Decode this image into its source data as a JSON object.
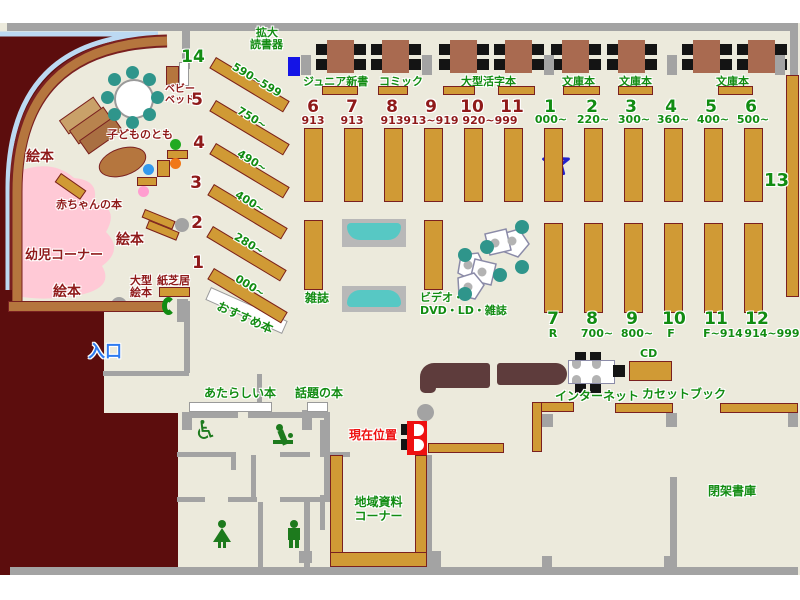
{
  "colors": {
    "floor": "#eceadc",
    "wall_gray": "#a3a3a3",
    "outside_maroon": "#5c0d0d",
    "shelf_gold": "#d09a35",
    "curve_wall_brown": "#b5763e",
    "outer_line_blue": "#bcd9f2",
    "toddler_area_pink": "#ffc9d6",
    "table_brown": "#a96a50",
    "counter_brown": "#5e3c3c",
    "seat_teal": "#2f958b",
    "sofa_teal": "#57c8c4",
    "green_text": "#128c12",
    "dark_red_text": "#8f1a1a",
    "entrance_blue": "#2e7bf0",
    "marker_red": "#ee1111",
    "device_blue": "#1414e6",
    "star_fill": "#f28585",
    "star_border": "#2222cc"
  },
  "labels": {
    "magnifier": [
      "拡大",
      "読書器"
    ],
    "junior_shinsho": "ジュニア新書",
    "comic": "コミック",
    "large_print": "大型活字本",
    "bunko": "文庫本",
    "shelf13": "13",
    "baby_bed": [
      "ベビー",
      "ベッド"
    ],
    "kodomo_no_tomo": "子どものとも",
    "ehon": "絵本",
    "akachan_books": "赤ちゃんの本",
    "yoji_corner": "幼児コーナー",
    "ogata_ehon": [
      "大型",
      "絵本"
    ],
    "kamishibai": "紙芝居",
    "osusume": "おすすめ本",
    "zasshi": "雑誌",
    "video": [
      "ビデオ・",
      "DVD・LD・雑誌"
    ],
    "iriguchi": "入口",
    "atarashii_hon": "あたらしい本",
    "wadai_no_hon": "話題の本",
    "genzai_ichi": "現在位置",
    "chiiki_shiryo": [
      "地域資料",
      "コーナー"
    ],
    "internet": "インターネット",
    "cd": "CD",
    "cassette_book": "カセットブック",
    "heika_shoko": "閉架書庫"
  },
  "left_diagonal": {
    "rows": [
      {
        "num": "14",
        "range": "590~599"
      },
      {
        "num": "5",
        "range": "750~"
      },
      {
        "num": "4",
        "range": "490~"
      },
      {
        "num": "3",
        "range": "400~"
      },
      {
        "num": "2",
        "range": "280~"
      },
      {
        "num": "1",
        "range": "000~"
      }
    ]
  },
  "top_group": {
    "nums": [
      "6",
      "7",
      "8",
      "9",
      "10",
      "11"
    ],
    "ranges": [
      "913",
      "913",
      "913",
      "913~919",
      "920~999"
    ]
  },
  "right_group": {
    "nums": [
      "1",
      "2",
      "3",
      "4",
      "5",
      "6"
    ],
    "ranges": [
      "000~",
      "220~",
      "300~",
      "360~",
      "400~",
      "500~"
    ]
  },
  "bottom_group": {
    "nums": [
      "7",
      "8",
      "9",
      "10",
      "11",
      "12"
    ],
    "ranges": [
      "R",
      "700~",
      "800~",
      "F",
      "F~914",
      "914~999"
    ]
  }
}
